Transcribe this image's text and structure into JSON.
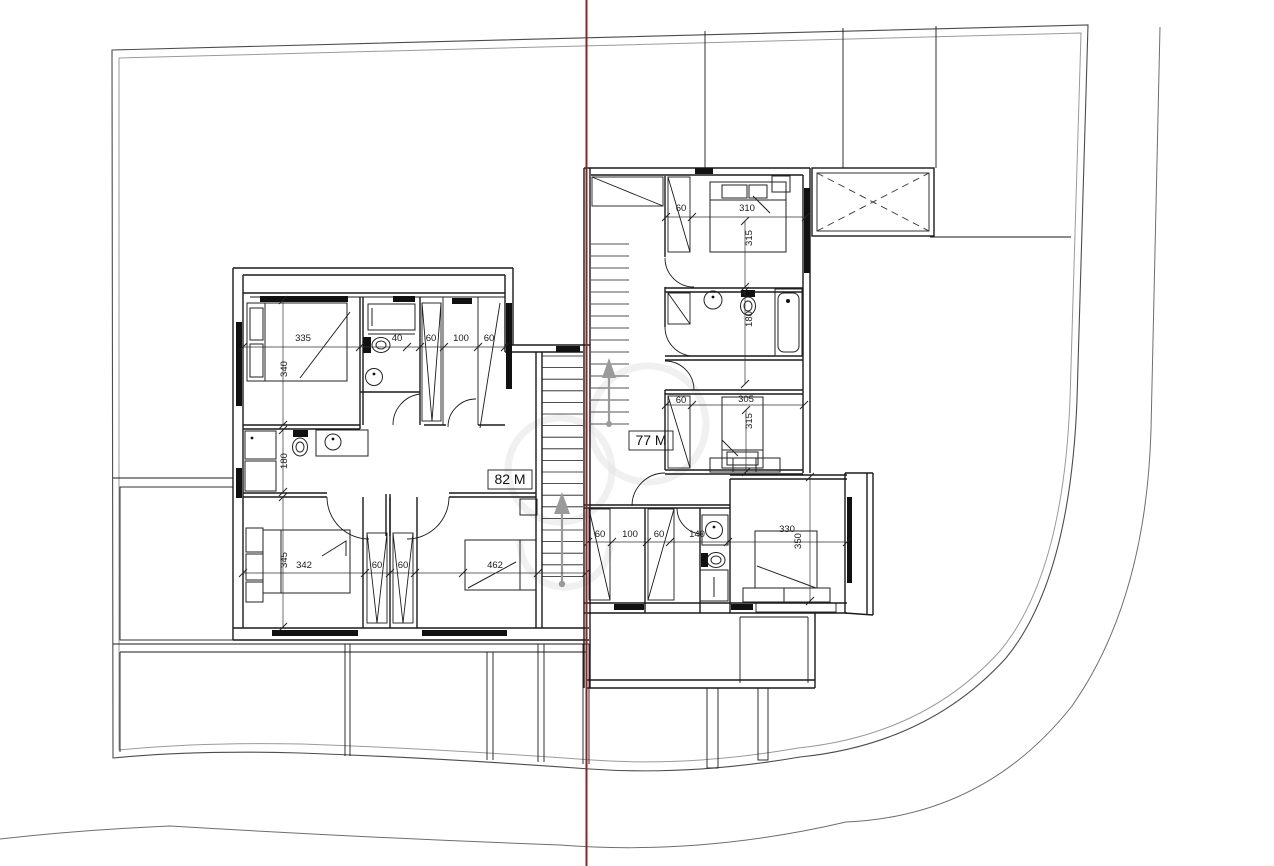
{
  "drawing": {
    "title": "floor-plan",
    "units": [
      {
        "id": "unit-left",
        "area_label": "82 M"
      },
      {
        "id": "unit-right",
        "area_label": "77 M"
      }
    ],
    "dimensions": [
      {
        "value": "335",
        "x": 303,
        "y": 341,
        "rot": 0
      },
      {
        "value": "340",
        "x": 287,
        "y": 369,
        "rot": -90
      },
      {
        "value": "40",
        "x": 397,
        "y": 341,
        "rot": 0
      },
      {
        "value": "60",
        "x": 431,
        "y": 341,
        "rot": 0
      },
      {
        "value": "100",
        "x": 461,
        "y": 341,
        "rot": 0
      },
      {
        "value": "60",
        "x": 489,
        "y": 341,
        "rot": 0
      },
      {
        "value": "180",
        "x": 287,
        "y": 461,
        "rot": -90
      },
      {
        "value": "345",
        "x": 287,
        "y": 560,
        "rot": -90
      },
      {
        "value": "342",
        "x": 304,
        "y": 568,
        "rot": 0
      },
      {
        "value": "60",
        "x": 377,
        "y": 568,
        "rot": 0
      },
      {
        "value": "60",
        "x": 403,
        "y": 568,
        "rot": 0
      },
      {
        "value": "462",
        "x": 495,
        "y": 568,
        "rot": 0
      },
      {
        "value": "60",
        "x": 681,
        "y": 211,
        "rot": 0
      },
      {
        "value": "310",
        "x": 747,
        "y": 211,
        "rot": 0
      },
      {
        "value": "315",
        "x": 752,
        "y": 238,
        "rot": -90
      },
      {
        "value": "180",
        "x": 752,
        "y": 319,
        "rot": -90
      },
      {
        "value": "60",
        "x": 681,
        "y": 403,
        "rot": 0
      },
      {
        "value": "305",
        "x": 746,
        "y": 402,
        "rot": 0
      },
      {
        "value": "315",
        "x": 752,
        "y": 421,
        "rot": -90
      },
      {
        "value": "60",
        "x": 600,
        "y": 537,
        "rot": 0
      },
      {
        "value": "100",
        "x": 630,
        "y": 537,
        "rot": 0
      },
      {
        "value": "60",
        "x": 659,
        "y": 537,
        "rot": 0
      },
      {
        "value": "140",
        "x": 697,
        "y": 537,
        "rot": 0
      },
      {
        "value": "330",
        "x": 787,
        "y": 532,
        "rot": 0
      },
      {
        "value": "350",
        "x": 801,
        "y": 541,
        "rot": -90
      }
    ],
    "colors": {
      "walls": "#1a1a1a",
      "boundary": "#4c4c4c",
      "boundary_inner": "#9a9a9a",
      "road": "#6e6e6e",
      "red_reference_line": "#8c2325",
      "stair_arrow": "#9a9a9a",
      "watermark": "#e3e3e3"
    }
  }
}
